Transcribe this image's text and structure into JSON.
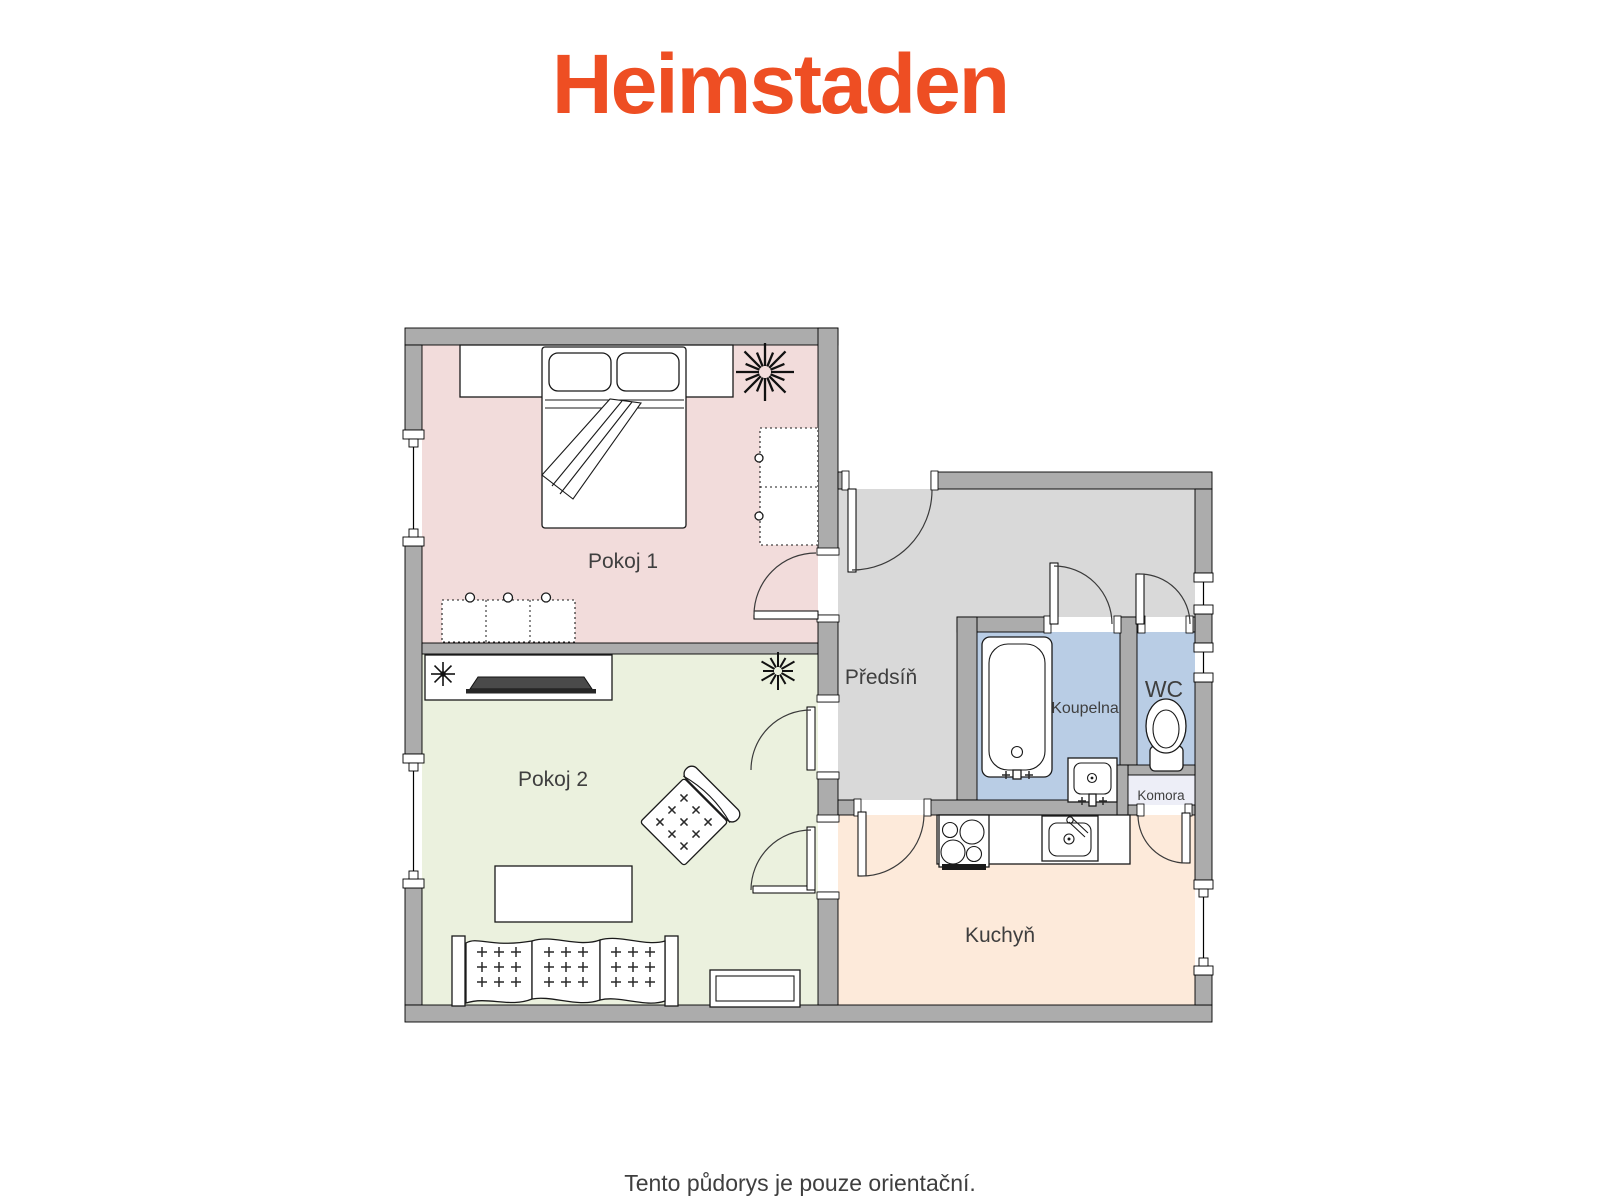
{
  "logo": {
    "text": "Heimstaden",
    "color": "#ee4e23"
  },
  "caption": {
    "text": "Tento půdorys je pouze orientační."
  },
  "floorplan": {
    "wall_color": "#acacac",
    "outline_color": "#000000",
    "label_color": "#3f3f3f",
    "rooms": [
      {
        "id": "pokoj1",
        "label": "Pokoj 1",
        "color": "#f2dcdb",
        "furniture": [
          "double-bed",
          "pillows",
          "wardrobe",
          "dresser",
          "plant"
        ]
      },
      {
        "id": "pokoj2",
        "label": "Pokoj 2",
        "color": "#ebf1de",
        "furniture": [
          "tv-cabinet",
          "plant",
          "armchair",
          "coffee-table",
          "sofa",
          "side-table"
        ]
      },
      {
        "id": "predsin",
        "label": "Předsíň",
        "color": "#d9d9d9",
        "furniture": []
      },
      {
        "id": "koupelna",
        "label": "Koupelna",
        "color": "#b9cde5",
        "furniture": [
          "bathtub",
          "washbasin"
        ]
      },
      {
        "id": "wc",
        "label": "WC",
        "color": "#b9cde5",
        "furniture": [
          "toilet"
        ]
      },
      {
        "id": "komora",
        "label": "Komora",
        "color": "#edeef7",
        "furniture": []
      },
      {
        "id": "kuchyn",
        "label": "Kuchyň",
        "color": "#fdeada",
        "furniture": [
          "stove",
          "countertop",
          "kitchen-sink"
        ]
      }
    ]
  }
}
